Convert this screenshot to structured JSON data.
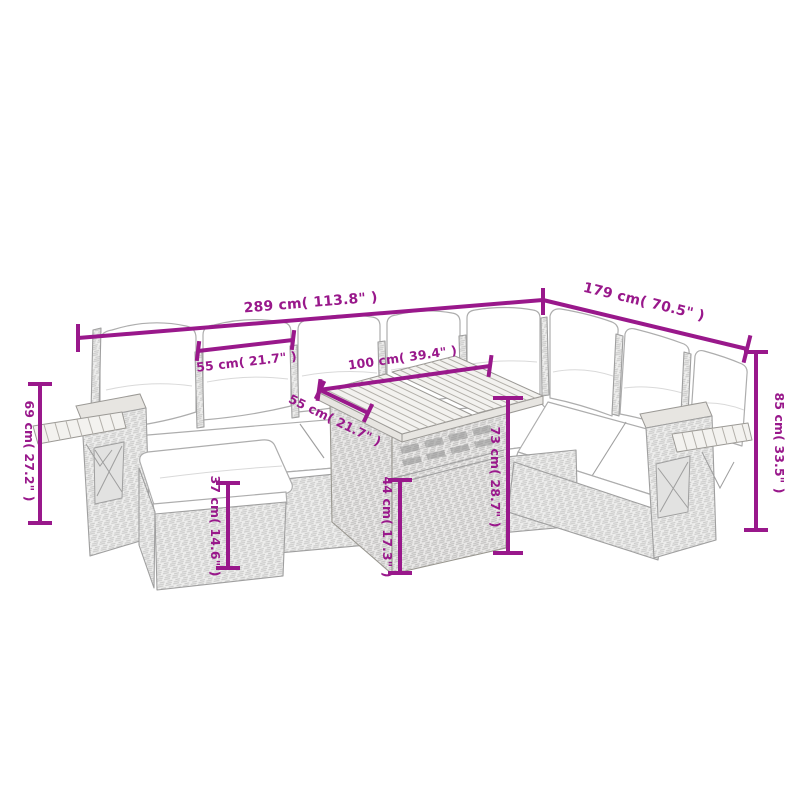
{
  "image": {
    "background_color": "#ffffff",
    "accent_color": "#99188B",
    "subject": "garden-lounge-set-dimension-diagram"
  },
  "dimensions": {
    "total_width": {
      "label": "289 cm( 113.8\" )"
    },
    "total_depth": {
      "label": "179 cm( 70.5\" )"
    },
    "backrest_height": {
      "label": "85 cm( 33.5\" )"
    },
    "armrest_height": {
      "label": "69 cm( 27.2\" )"
    },
    "seat_width": {
      "label": "55 cm( 21.7\" )"
    },
    "table_top_length": {
      "label": "100 cm( 39.4\" )"
    },
    "table_top_depth": {
      "label": "55 cm( 21.7\" )"
    },
    "table_height": {
      "label": "73 cm( 28.7\" )"
    },
    "table_shelf_height": {
      "label": "44 cm( 17.3\" )"
    },
    "footstool_height": {
      "label": "37 cm( 14.6\" )"
    }
  }
}
